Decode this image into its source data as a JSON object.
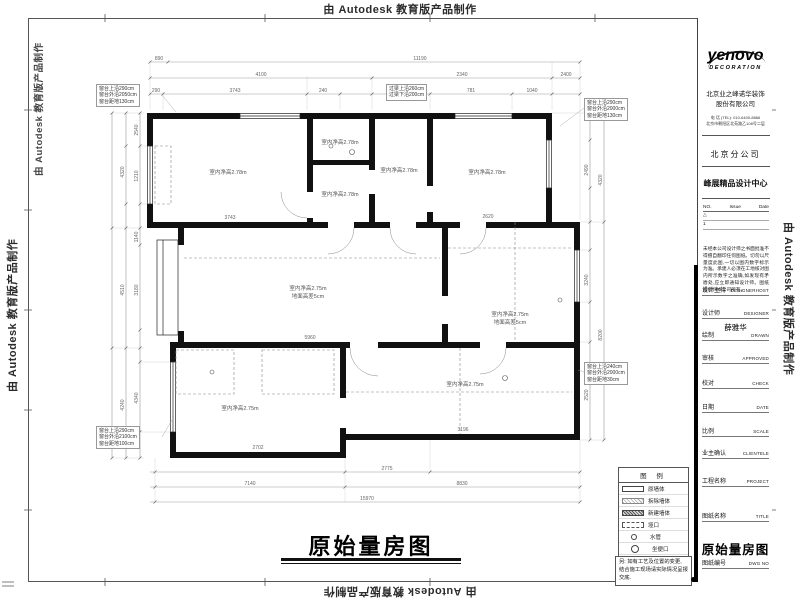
{
  "watermark": {
    "text": "由 Autodesk 教育版产品制作"
  },
  "sheet": {
    "main_title": "原始量房图"
  },
  "titleblock": {
    "logo": "yenovo",
    "logo_sub": "DECORATION",
    "company_line1": "北京业之峰诺华装饰",
    "company_line2": "股份有限公司",
    "addr1": "电 话 (TEL): 010-6400-8866",
    "addr2": "北京市朝阳区北苑路乙108号二层",
    "branch": "北京分公司",
    "studio": "峰展精品设计中心",
    "issue_header": {
      "no": "NO.",
      "issue": "Issue",
      "date": "Date"
    },
    "issue_rows": [
      {
        "no": "△"
      },
      {
        "no": "1"
      }
    ],
    "disclaimer": "未经本公司设计师之书面批准不得擅自翻印任何图纸。切勿以尺量度此图,一切以图内数字标示为准。承建人必须在工地核对图内所示数字之准确,如发现有矛盾处,应立即通知设计师。图纸版权归本公司所有。",
    "rows": [
      {
        "cn": "设计主持",
        "en": "DESIGNERHOST",
        "value": ""
      },
      {
        "cn": "设计师",
        "en": "DESIGNER",
        "value": "薛雅华"
      },
      {
        "cn": "绘制",
        "en": "DRAWN",
        "value": ""
      },
      {
        "cn": "审核",
        "en": "APPROVED",
        "value": ""
      },
      {
        "cn": "校对",
        "en": "CHECK",
        "value": ""
      },
      {
        "cn": "日期",
        "en": "DATE",
        "value": ""
      },
      {
        "cn": "比例",
        "en": "SCALE",
        "value": ""
      },
      {
        "cn": "业主确认",
        "en": "CLIENTELE",
        "value": ""
      },
      {
        "cn": "工程名称",
        "en": "PROJECT",
        "value": ""
      },
      {
        "cn": "图纸名称",
        "en": "TITLE",
        "value": "原始量房图"
      },
      {
        "cn": "图纸编号",
        "en": "DWG NO",
        "value": ""
      }
    ]
  },
  "legend": {
    "title": "图 例",
    "items": [
      {
        "label": "原墙体"
      },
      {
        "label": "拆除墙体"
      },
      {
        "label": "新建墙体"
      },
      {
        "label": "垭口"
      },
      {
        "label": "水管"
      },
      {
        "label": "坐便口"
      },
      {
        "label": "地漏"
      }
    ],
    "note": "另: 如有工艺及位置的变更, 结合施工现场请实际情况呈报交底."
  },
  "plan": {
    "room_label_high": "室内净高2.78m",
    "room_label_low": "室内净高2.75m",
    "floor_note": "地面高差5cm",
    "annotations": {
      "a1": [
        "窗台上沿290cm",
        "窗台外沿2050cm",
        "窗台距地130cm"
      ],
      "a2": [
        "窗台上沿290cm",
        "窗台外沿2000cm",
        "窗台距地130cm"
      ],
      "a3": [
        "窗台上沿240cm",
        "窗台外沿2000cm",
        "窗台距地30cm"
      ],
      "a4": [
        "窗台上沿290cm",
        "窗台外沿2100cm",
        "窗台距地100cm"
      ],
      "a5": [
        "过梁上沿260cm",
        "过梁下沿200cm"
      ]
    },
    "dims_top": [
      "890",
      "11190",
      "4100",
      "2340",
      "2400",
      "290",
      "3743",
      "240",
      "860",
      "781",
      "1040"
    ],
    "dims_left": [
      "2540",
      "1210",
      "1140",
      "3180",
      "4340",
      "4320",
      "4510",
      "4240"
    ],
    "dims_right": [
      "2490",
      "3240",
      "2520",
      "4320",
      "8200"
    ],
    "dims_bottom": [
      "2775",
      "7140",
      "8830",
      "15970"
    ],
    "dims_inner": [
      "3743",
      "2620",
      "5960",
      "2702",
      "3196"
    ]
  }
}
